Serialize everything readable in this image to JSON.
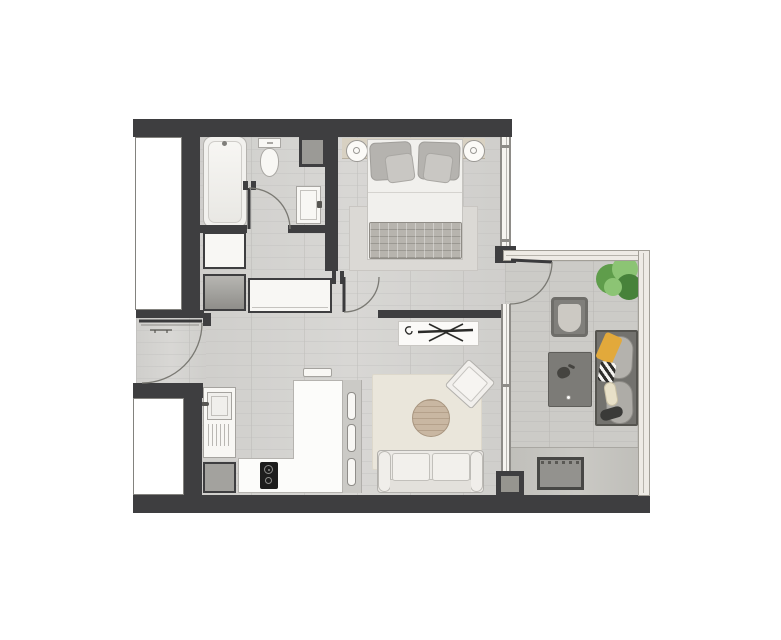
{
  "meta": {
    "title": "apartment-floor-plan",
    "type": "architectural-floor-plan-top-view",
    "canvas_width": 781,
    "canvas_height": 640,
    "visible_text": "none"
  },
  "palette": {
    "background": "#ffffff",
    "wall": "#3e3e40",
    "floor": "#d6d5d2",
    "balconyFloor": "#cccbc7",
    "concrete": "#c7c6c1",
    "windowGlass": "#f6f4f0",
    "frameCream": "#eeebe5",
    "fixtureWhite": "#f8f7f4",
    "fixtureBorder": "#a9a7a3",
    "counter": "#fcfcfa",
    "grayCabinet": "#a3a29e",
    "shaftGray": "#9b9a96",
    "hob": "#1d1d1d",
    "rugLiving": "#eae6db",
    "rugBed": "#dbd9d5",
    "woodTable": "#c9b7a2",
    "sofa": "#eceae6",
    "cushionGray": "#b5b3af",
    "blanket": "#b7b4ae",
    "headboard": "#d8d1c2",
    "benchFrame": "#73726e",
    "balconyCushion": "#b4b2ad",
    "throwYellow": "#e2a93b",
    "plantGreen": "#5f9d4b",
    "plantGreenDark": "#47823a",
    "plantGreenLight": "#8cc474",
    "doorArc": "#7a7973"
  },
  "rooms": [
    {
      "name": "bathroom",
      "items": [
        "bathtub",
        "toilet",
        "washbasin",
        "service-shaft",
        "storage-cabinet",
        "open-shelf",
        "bathroom-door"
      ]
    },
    {
      "name": "hallway-entrance",
      "items": [
        "entrance-door",
        "wardrobe"
      ]
    },
    {
      "name": "bedroom",
      "items": [
        "double-bed",
        "headboard",
        "bedside-lamp-left",
        "bedside-lamp-right",
        "pillows",
        "throw-blanket",
        "area-rug",
        "bedroom-door",
        "window"
      ]
    },
    {
      "name": "kitchen",
      "items": [
        "sink-unit",
        "base-cabinet",
        "countertop-l-shape",
        "hob-two-burner",
        "tall-cabinet-handles"
      ]
    },
    {
      "name": "living-area",
      "items": [
        "sofa",
        "armchair",
        "round-coffee-table",
        "area-rug",
        "tv-sideboard",
        "window",
        "balcony-door",
        "column"
      ]
    },
    {
      "name": "balcony",
      "items": [
        "potted-plant",
        "lounge-chair",
        "side-table",
        "bench-sofa",
        "yellow-throw",
        "planter-box",
        "railing-frame"
      ]
    }
  ]
}
